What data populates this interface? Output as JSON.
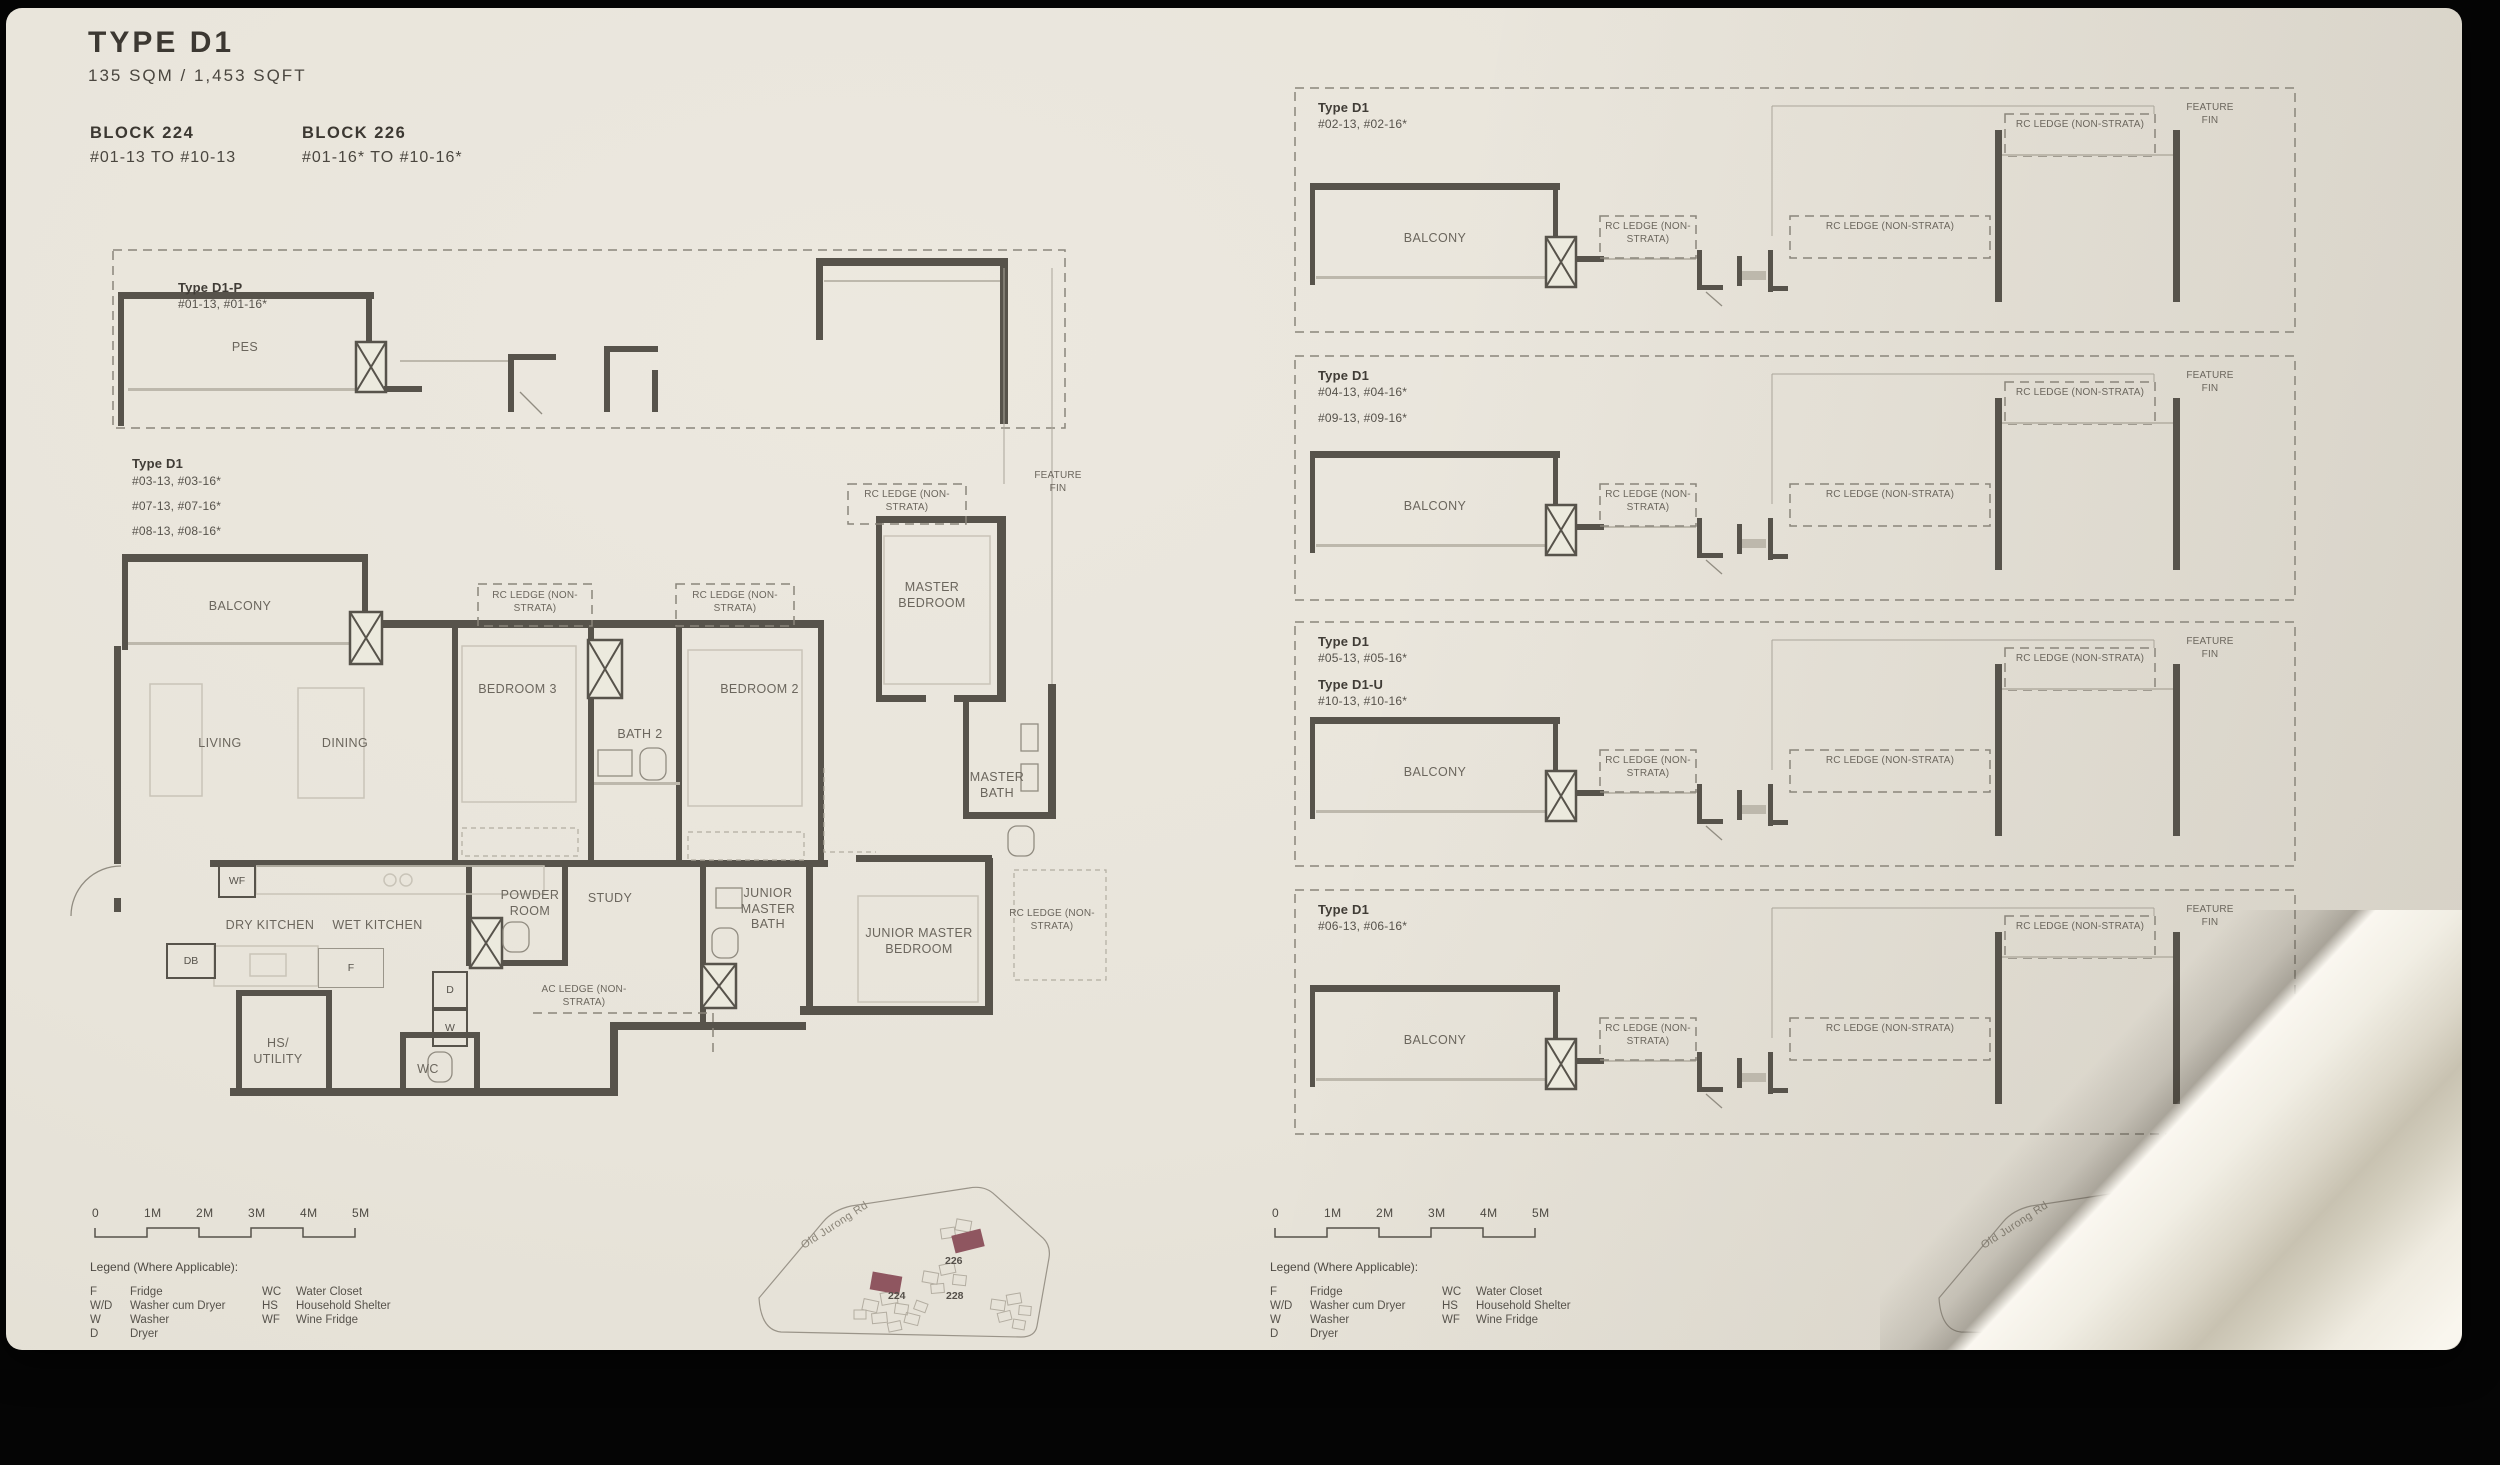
{
  "page": {
    "title": "TYPE D1",
    "area": "135 SQM / 1,453 SQFT",
    "blocks": [
      {
        "name": "BLOCK 224",
        "range": "#01-13 TO #10-13"
      },
      {
        "name": "BLOCK 226",
        "range": "#01-16* TO #10-16*"
      }
    ]
  },
  "labels": {
    "balcony": "BALCONY",
    "rc_ledge": "RC LEDGE (NON-STRATA)",
    "feature_fin": "FEATURE FIN",
    "x_marker": "X"
  },
  "pes_plan": {
    "type": "Type D1-P",
    "units": "#01-13, #01-16*",
    "room": "PES"
  },
  "main_plan": {
    "type": "Type D1",
    "units": [
      "#03-13, #03-16*",
      "#07-13, #07-16*",
      "#08-13, #08-16*"
    ],
    "rooms": {
      "living": "LIVING",
      "dining": "DINING",
      "bedroom3": "BEDROOM 3",
      "bath2": "BATH 2",
      "bedroom2": "BEDROOM 2",
      "master_bedroom": "MASTER BEDROOM",
      "master_bath": "MASTER BATH",
      "junior_master_bath": "JUNIOR MASTER BATH",
      "junior_master_bedroom": "JUNIOR MASTER BEDROOM",
      "dry_kitchen": "DRY KITCHEN",
      "wet_kitchen": "WET KITCHEN",
      "powder_room": "POWDER ROOM",
      "study": "STUDY",
      "hs_utility": "HS/ UTILITY",
      "wc": "WC",
      "ac_ledge": "AC LEDGE (NON-STRATA)"
    },
    "tags": {
      "wf": "WF",
      "db": "DB",
      "f": "F",
      "d": "D",
      "w": "W"
    }
  },
  "elevations": [
    {
      "type": "Type D1",
      "units": "#02-13, #02-16*"
    },
    {
      "type": "Type D1",
      "units": "#04-13, #04-16*",
      "units2": "#09-13, #09-16*"
    },
    {
      "type": "Type D1",
      "units": "#05-13, #05-16*",
      "type2": "Type D1-U",
      "units2": "#10-13, #10-16*"
    },
    {
      "type": "Type D1",
      "units": "#06-13, #06-16*"
    }
  ],
  "scale_bar": [
    "0",
    "1M",
    "2M",
    "3M",
    "4M",
    "5M"
  ],
  "legend": {
    "title": "Legend (Where Applicable):",
    "left": [
      {
        "abbr": "F",
        "desc": "Fridge"
      },
      {
        "abbr": "W/D",
        "desc": "Washer cum Dryer"
      },
      {
        "abbr": "W",
        "desc": "Washer"
      },
      {
        "abbr": "D",
        "desc": "Dryer"
      }
    ],
    "right": [
      {
        "abbr": "WC",
        "desc": "Water Closet"
      },
      {
        "abbr": "HS",
        "desc": "Household Shelter"
      },
      {
        "abbr": "WF",
        "desc": "Wine Fridge"
      }
    ]
  },
  "site_map": {
    "road": "Old Jurong Rd",
    "blocks": [
      "224",
      "226",
      "228"
    ],
    "highlight_color": "#8f5660"
  }
}
